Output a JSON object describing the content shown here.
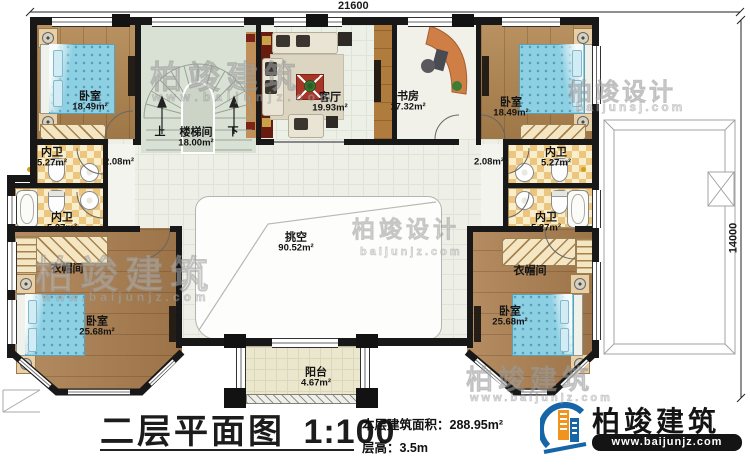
{
  "plan": {
    "dimension_top": "21600",
    "dimension_right": "14000",
    "rooms": {
      "bedroom_tl": {
        "name": "卧室",
        "area": "18.49m²"
      },
      "stairwell": {
        "name": "楼梯间",
        "area": "18.00m²",
        "up_label": "上",
        "down_label": "下"
      },
      "living_room": {
        "name": "客厅",
        "area": "19.93m²"
      },
      "study": {
        "name": "书房",
        "area": "17.32m²"
      },
      "bedroom_tr": {
        "name": "卧室",
        "area": "18.49m²"
      },
      "bath_l1": {
        "name": "内卫",
        "area": "5.27m²"
      },
      "bath_l2": {
        "name": "内卫",
        "area": "5.27m²"
      },
      "bath_r1": {
        "name": "内卫",
        "area": "5.27m²"
      },
      "bath_r2": {
        "name": "内卫",
        "area": "5.27m²"
      },
      "hall_left": {
        "area": "2.08m²"
      },
      "hall_right": {
        "area": "2.08m²"
      },
      "void": {
        "name": "挑空",
        "area": "90.52m²"
      },
      "cloakroom_left": {
        "name": "衣帽间"
      },
      "cloakroom_right": {
        "name": "衣帽间"
      },
      "bedroom_bl": {
        "name": "卧室",
        "area": "25.68m²"
      },
      "bedroom_br": {
        "name": "卧室",
        "area": "25.68m²"
      },
      "balcony": {
        "name": "阳台",
        "area": "4.67m²"
      }
    }
  },
  "title_block": {
    "title": "二层平面图",
    "scale": "1:100",
    "area_line": "本层建筑面积：288.95m²",
    "floor_height_line": "层高：3.5m"
  },
  "brand": {
    "name": "柏竣建筑",
    "website": "www.baijunjz.com"
  },
  "watermarks": {
    "center_top": {
      "text": "柏竣建筑",
      "sub": "www.baijunjz.com"
    },
    "right_top": {
      "text": "柏竣设计",
      "sub": "baijunsj.com"
    },
    "left_middle": {
      "text": "柏竣建筑",
      "sub": "www.baijunjz.com"
    },
    "void_area": {
      "text": "柏竣设计",
      "sub": "baijunjz.com"
    },
    "bottom_right": {
      "text": "柏竣建筑",
      "sub": "www.baijunjz.com"
    }
  },
  "palette": {
    "wood": "#b1854f",
    "bed_blue": "#8ed0e3",
    "tile_checker": "#ecc67e",
    "stair_floor": "#d9e1d4",
    "balcony_floor": "#ebe7cf",
    "wall": "#181818",
    "brand_blue": "#1565a8",
    "brand_orange": "#f0941d"
  }
}
